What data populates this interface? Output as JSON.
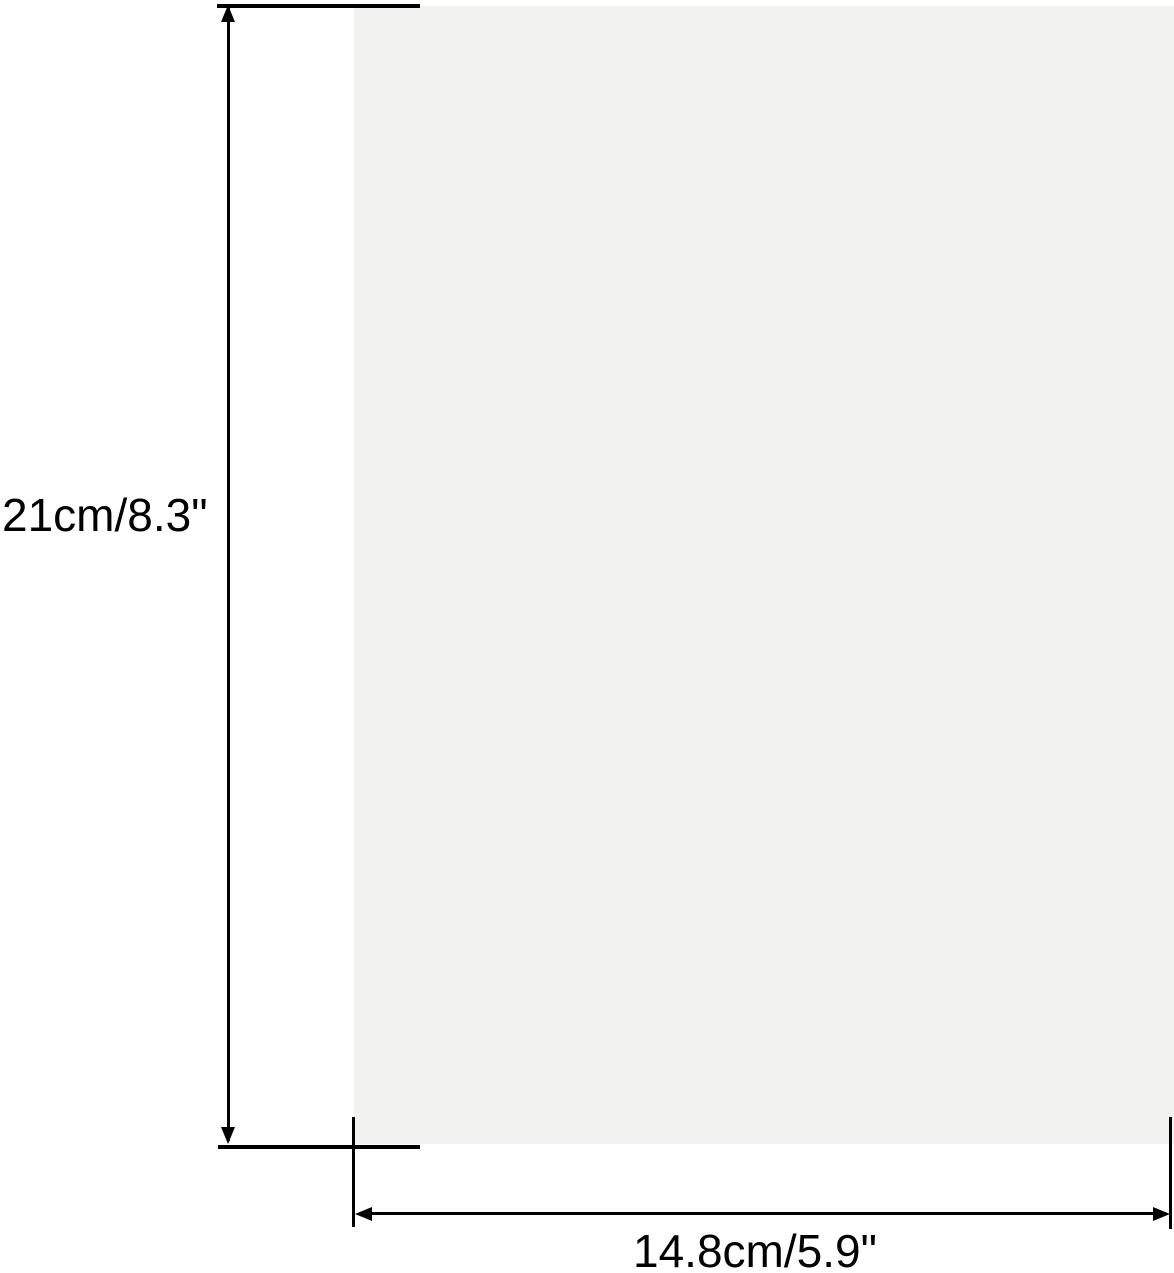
{
  "figure": {
    "type": "product-dimension-diagram",
    "background_color": "#ffffff",
    "line_color": "#000000",
    "sheet": {
      "description": "blank sheet of paper shown edge-to-edge at right",
      "fill_color": "#f2f2f1"
    },
    "height_dimension": {
      "label": "21cm/8.3\"",
      "value_cm": 21,
      "value_inch": 8.3
    },
    "width_dimension": {
      "label": "14.8cm/5.9\"",
      "value_cm": 14.8,
      "value_inch": 5.9
    }
  }
}
